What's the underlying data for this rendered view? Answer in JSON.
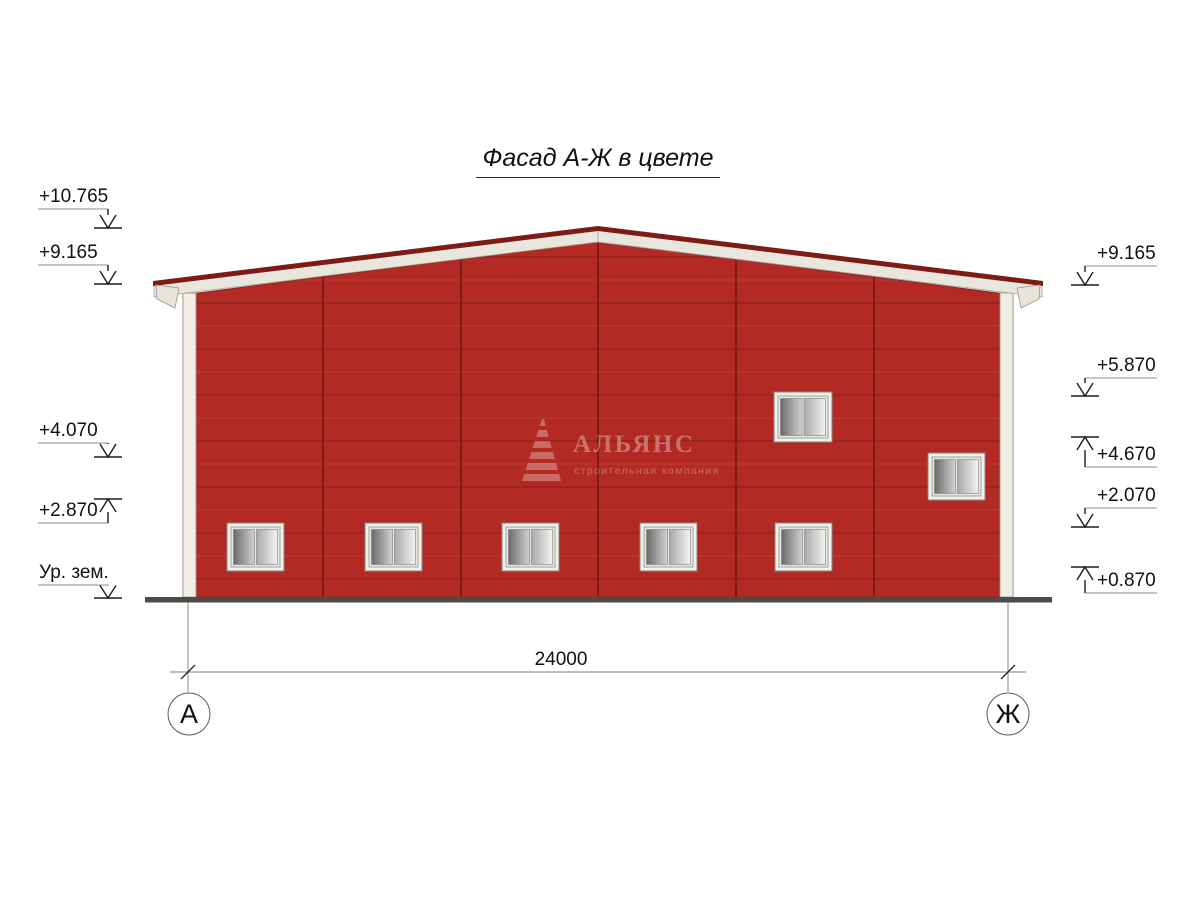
{
  "title": "Фасад А-Ж в цвете",
  "watermark": {
    "logo": "pyramid-logo",
    "name": "АЛЬЯНС",
    "subtitle": "строительная компания"
  },
  "elevations": {
    "left": [
      {
        "label": "+10.765",
        "direction": "down"
      },
      {
        "label": "+9.165",
        "direction": "down"
      },
      {
        "label": "+4.070",
        "direction": "down"
      },
      {
        "label": "+2.870",
        "direction": "up"
      },
      {
        "label": "Ур. зем.",
        "direction": "down"
      }
    ],
    "right": [
      {
        "label": "+9.165",
        "direction": "down"
      },
      {
        "label": "+5.870",
        "direction": "down"
      },
      {
        "label": "+4.670",
        "direction": "up"
      },
      {
        "label": "+2.070",
        "direction": "down"
      },
      {
        "label": "+0.870",
        "direction": "up"
      }
    ]
  },
  "dimension": {
    "value": "24000"
  },
  "axes": {
    "left": "А",
    "right": "Ж"
  },
  "facade": {
    "bays": 6,
    "windows_bottom_row": 5,
    "windows_upper": 2
  },
  "colors": {
    "wall": "#B22A23",
    "panel_seam": "#8E231D",
    "roof_cap": "#7E1B16",
    "fascia": "#E9E7DD",
    "corner_trim": "#EFEDE4",
    "ground": "#4B4B4A",
    "window_frame": "#F1F0EA"
  }
}
